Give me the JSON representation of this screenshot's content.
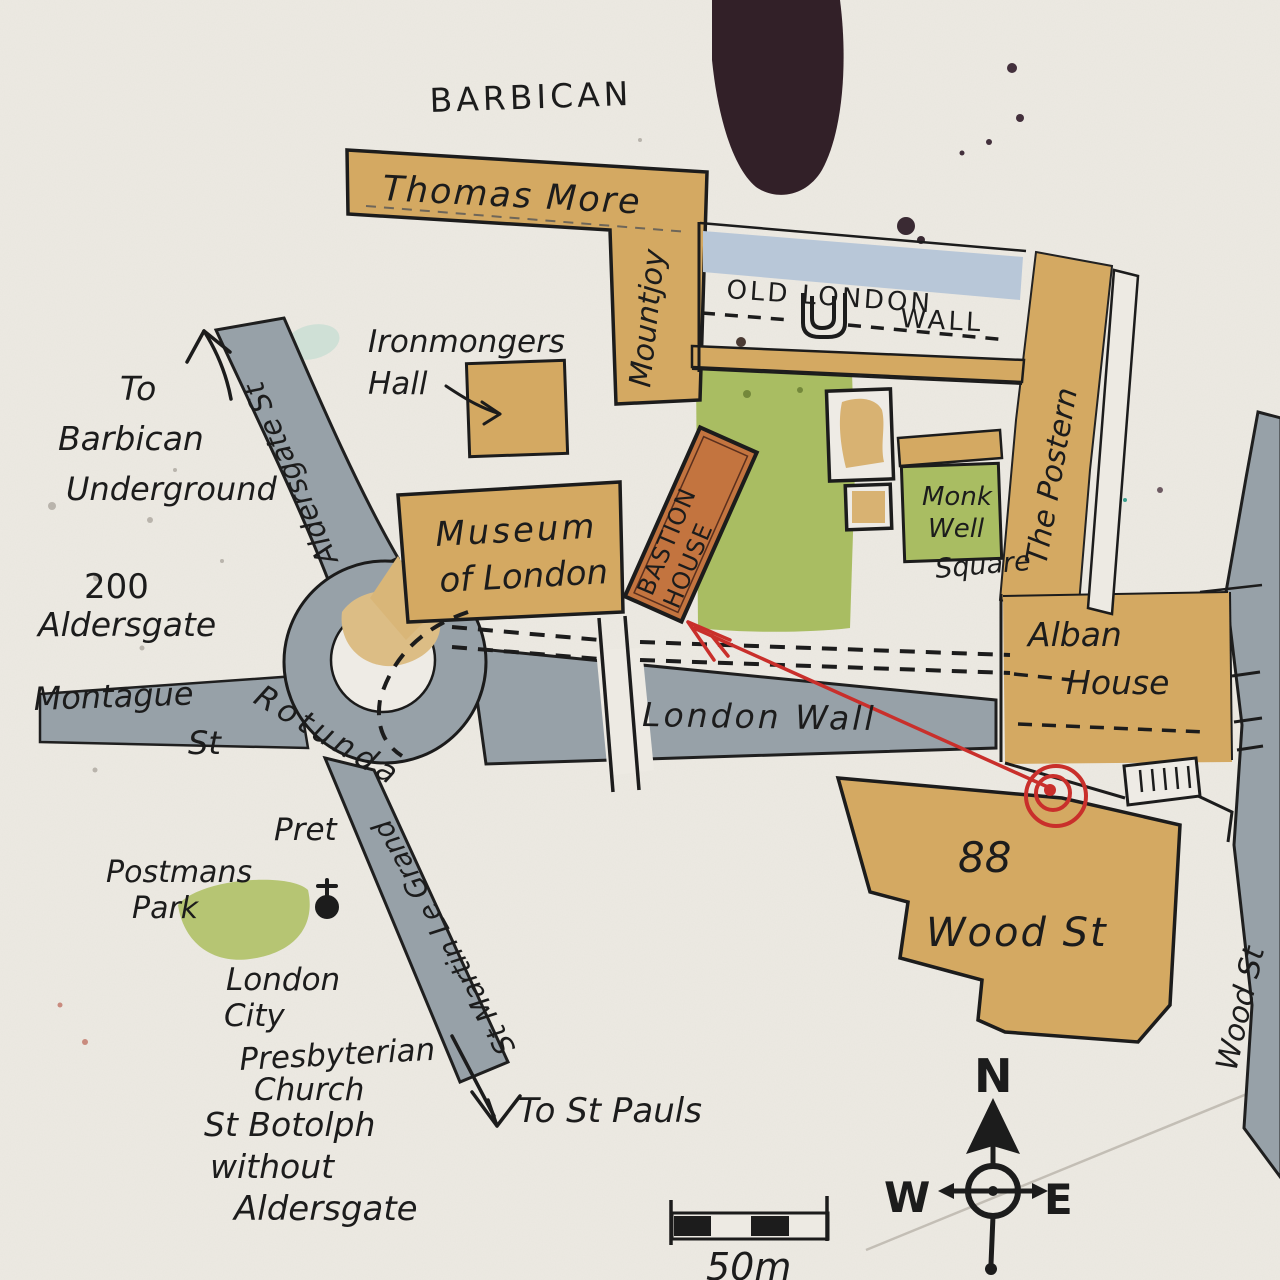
{
  "title": "Hand-drawn watercolour map of the Barbican / London Wall area",
  "palette": {
    "paper": "#edeae3",
    "road_gray": "#97a1a8",
    "building_tan": "#d4a962",
    "island_tan": "#dcbd85",
    "park_green": "#a9bd62",
    "postmans_green": "#b6c573",
    "wall_blue": "#b8c7d8",
    "bastion_orange": "#c3743f",
    "annotation_red": "#c92f2b",
    "ink": "#1c1c1c",
    "ink_blob": "#322028",
    "pencil": "#6e6659"
  },
  "labels": {
    "barbican": "BARBICAN",
    "thomas_more": "Thomas More",
    "mountjoy": "Mountjoy",
    "old_london_1": "OLD LONDON",
    "old_london_2": "WALL",
    "ironmongers_1": "Ironmongers",
    "ironmongers_2": "Hall",
    "postern": "The Postern",
    "museum_1": "Museum",
    "museum_2": "of London",
    "bastion_1": "BASTION",
    "bastion_2": "HOUSE",
    "monkwell_1": "Monk",
    "monkwell_2": "Well",
    "monkwell_3": "Square",
    "alban_1": "Alban",
    "alban_2": "House",
    "to_barbican_1": "To",
    "to_barbican_2": "Barbican",
    "to_barbican_3": "Underground",
    "aldersgate_st": "Aldersgate St",
    "two_hundred_1": "200",
    "two_hundred_2": "Aldersgate",
    "montague_1": "Montague",
    "montague_2": "St",
    "rotunda": "Rotunda",
    "london_wall_road": "London Wall",
    "pret": "Pret",
    "postmans_1": "Postmans",
    "postmans_2": "Park",
    "church_1": "London",
    "church_2": "City",
    "church_3": "Presbyterian",
    "church_4": "Church",
    "botolph_1": "St Botolph",
    "botolph_2": "without",
    "botolph_3": "Aldersgate",
    "st_martin": "St Martin Le Grand",
    "to_st_pauls": "To St Pauls",
    "wood88_1": "88",
    "wood88_2": "Wood St",
    "wood_st_road": "Wood St",
    "compass_n": "N",
    "compass_w": "W",
    "compass_e": "E",
    "scale_50m": "50m"
  }
}
